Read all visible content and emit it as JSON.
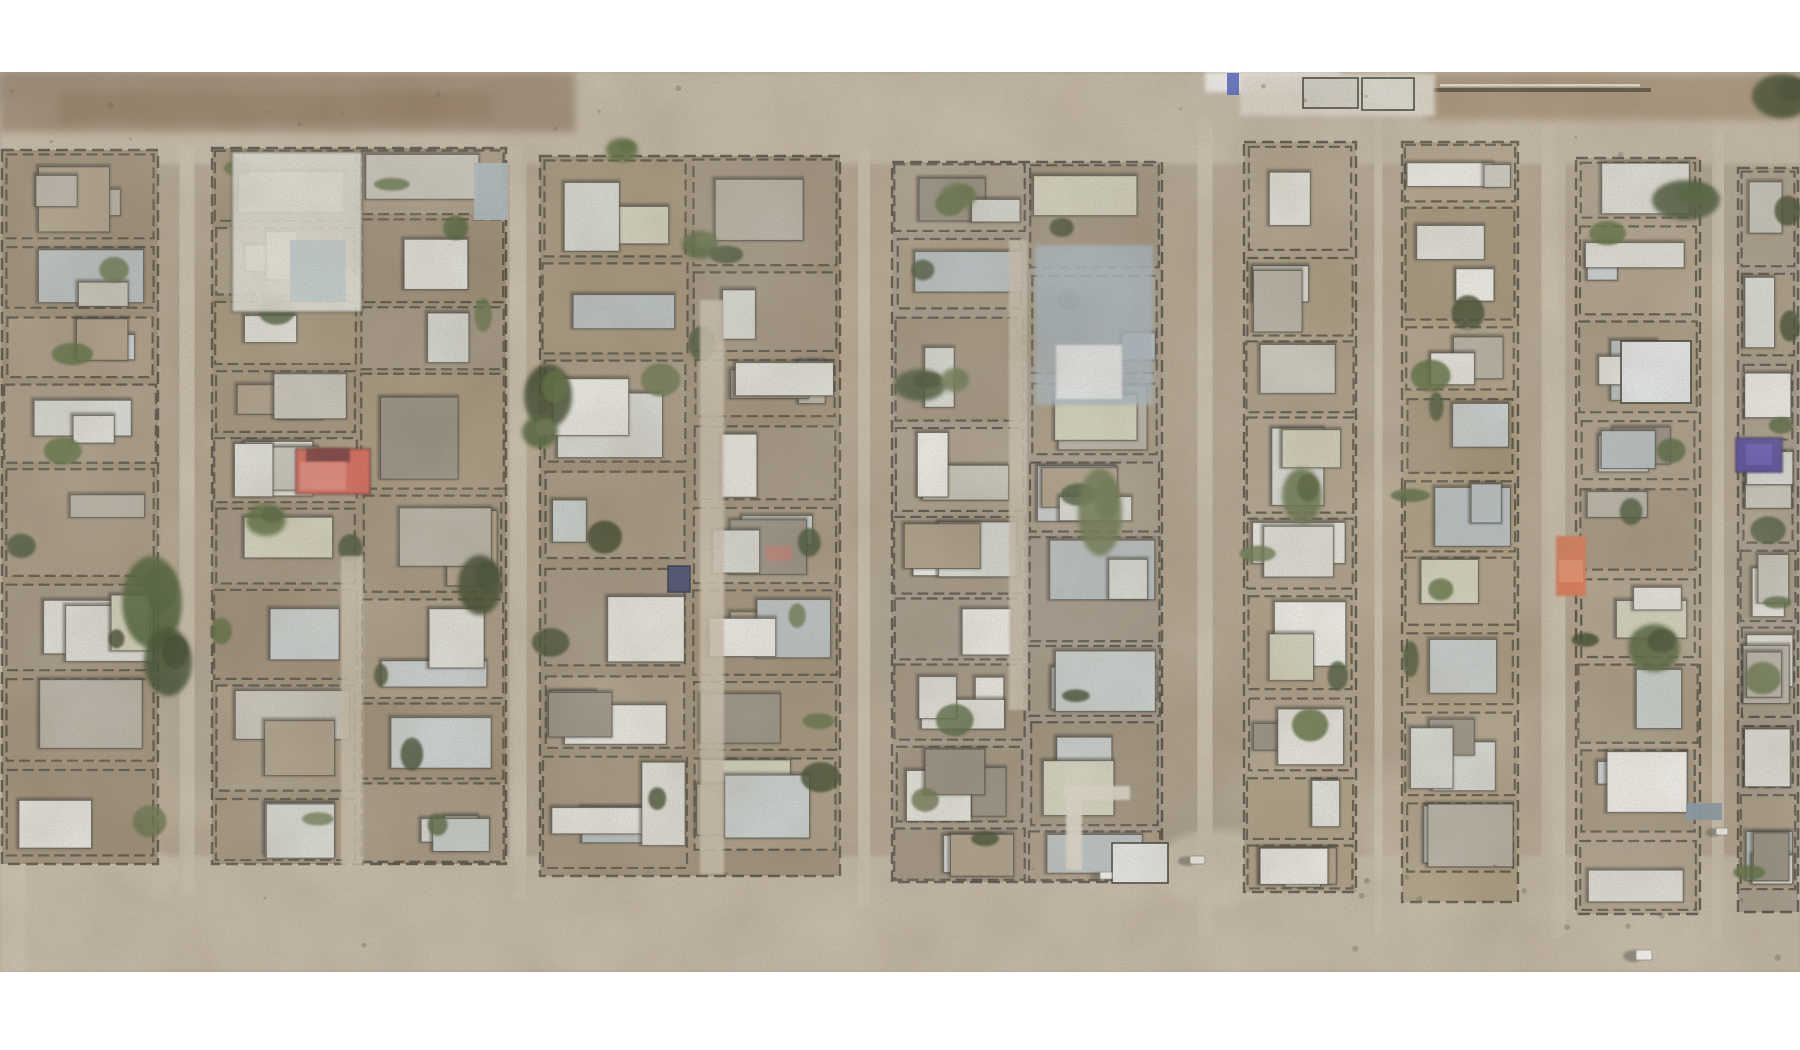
{
  "scene": {
    "canvas": {
      "width": 1800,
      "height": 1050,
      "letterbox_color": "#ffffff",
      "image_top": 72,
      "image_bottom": 972
    },
    "palette": {
      "desert_base": "#b1a28c",
      "haze": "#cfc6b6",
      "road": "#c6baa7",
      "road_light": "#cfc4b1",
      "block_ground": [
        "#a89878",
        "#9f8f76",
        "#ab9c86",
        "#95856c",
        "#b0a28c",
        "#a09484"
      ],
      "roofs": [
        "#eeefe9",
        "#e6e8e1",
        "#f5f6f2",
        "#cbcabf",
        "#b6b2a5",
        "#ccd4d6",
        "#b7c3c7",
        "#a99b84",
        "#90897b",
        "#dde1dd",
        "#d8d8c2"
      ],
      "walls": "#2c2a21",
      "roof_shadow": "#23221b",
      "trees": [
        "#2e4220",
        "#3a5226",
        "#47602c",
        "#263619",
        "#56683a"
      ],
      "mottle": [
        "#8d7d66",
        "#d3c7b2",
        "#9c9c98",
        "#b7a98f"
      ],
      "debris": "#5e5547",
      "vehicle_white": "#fbfbf9"
    },
    "regions": {
      "top_road": {
        "x": 0,
        "y": 72,
        "w": 1800,
        "h": 92
      },
      "bottom_road": {
        "x": 0,
        "y": 856,
        "w": 1800,
        "h": 116
      },
      "left_edge_strip": {
        "x": 0,
        "y": 560,
        "w": 26,
        "h": 412
      },
      "bottomleft_curve": {
        "d": "M 8 600 Q 40 790 170 888",
        "width": 46
      },
      "r4_junction_bulge": {
        "cx": 1218,
        "cy": 868,
        "rx": 64,
        "ry": 38
      }
    },
    "vertical_roads": [
      {
        "id": "r1",
        "x_top": 182,
        "x_bottom": 192,
        "w": 50,
        "y_top": 145,
        "y_bottom": 895
      },
      {
        "id": "r2",
        "x_top": 512,
        "x_bottom": 524,
        "w": 46,
        "y_top": 145,
        "y_bottom": 900
      },
      {
        "id": "r3",
        "x_top": 868,
        "x_bottom": 860,
        "w": 46,
        "y_top": 150,
        "y_bottom": 905
      },
      {
        "id": "r4",
        "x_top": 1210,
        "x_bottom": 1200,
        "w": 64,
        "y_top": 118,
        "y_bottom": 935
      },
      {
        "id": "r5",
        "x_top": 1380,
        "x_bottom": 1376,
        "w": 40,
        "y_top": 115,
        "y_bottom": 932
      },
      {
        "id": "r6",
        "x_top": 1545,
        "x_bottom": 1562,
        "w": 42,
        "y_top": 125,
        "y_bottom": 938
      },
      {
        "id": "r7",
        "x_top": 1722,
        "x_bottom": 1714,
        "w": 34,
        "y_top": 130,
        "y_bottom": 938
      }
    ],
    "blocks": [
      {
        "id": "A",
        "x0": 2,
        "x1": 158,
        "top": 150,
        "bottom": 864,
        "seed": 11
      },
      {
        "id": "B",
        "x0": 212,
        "x1": 506,
        "top": 148,
        "bottom": 864,
        "seed": 22
      },
      {
        "id": "C",
        "x0": 540,
        "x1": 840,
        "top": 156,
        "bottom": 876,
        "seed": 33
      },
      {
        "id": "D",
        "x0": 892,
        "x1": 1162,
        "top": 162,
        "bottom": 882,
        "seed": 44
      },
      {
        "id": "E",
        "x0": 1244,
        "x1": 1356,
        "top": 142,
        "bottom": 892,
        "seed": 55
      },
      {
        "id": "F",
        "x0": 1402,
        "x1": 1518,
        "top": 142,
        "bottom": 902,
        "seed": 66
      },
      {
        "id": "G",
        "x0": 1576,
        "x1": 1700,
        "top": 158,
        "bottom": 914,
        "seed": 77
      },
      {
        "id": "H",
        "x0": 1738,
        "x1": 1798,
        "top": 168,
        "bottom": 912,
        "seed": 88
      }
    ],
    "alleys": [
      {
        "x": 352,
        "y_top": 556,
        "y_bottom": 866,
        "w": 22
      },
      {
        "x": 712,
        "y_top": 300,
        "y_bottom": 874,
        "w": 24
      },
      {
        "x": 1018,
        "y_top": 240,
        "y_bottom": 710,
        "w": 18
      }
    ],
    "features": [
      {
        "name": "top-blue-gray-patch",
        "shape": "rect",
        "x": 0,
        "y": 72,
        "w": 152,
        "h": 32,
        "color": "#8b9095",
        "opacity": 0.9,
        "blur": "b4"
      },
      {
        "name": "top-brown-strip-left",
        "shape": "rect",
        "x": 0,
        "y": 72,
        "w": 575,
        "h": 60,
        "color": "#97826a",
        "opacity": 0.95,
        "blur": "b4"
      },
      {
        "name": "top-brown-strip-left-dark",
        "shape": "rect",
        "x": 60,
        "y": 92,
        "w": 430,
        "h": 30,
        "color": "#87704f",
        "opacity": 0.6,
        "blur": "b4"
      },
      {
        "name": "top-brown-strip-right",
        "shape": "rect",
        "x": 1425,
        "y": 74,
        "w": 375,
        "h": 46,
        "color": "#a28c6e",
        "opacity": 0.9,
        "blur": "b4"
      },
      {
        "name": "top-right-wall-line",
        "shape": "rect",
        "x": 1433,
        "y": 88,
        "w": 218,
        "h": 4,
        "color": "#3b3528",
        "opacity": 0.85,
        "blur": ""
      },
      {
        "name": "top-right-wall-highlight",
        "shape": "rect",
        "x": 1440,
        "y": 84,
        "w": 200,
        "h": 2.5,
        "color": "#f2f1ea",
        "opacity": 0.9,
        "blur": ""
      },
      {
        "name": "top-white-notch",
        "shape": "rect",
        "x": 1205,
        "y": 72,
        "w": 135,
        "h": 20,
        "color": "#ffffff",
        "opacity": 1,
        "blur": "b2"
      },
      {
        "name": "top-bright-ground",
        "shape": "rect",
        "x": 1240,
        "y": 74,
        "w": 195,
        "h": 42,
        "color": "#e6e1d5",
        "opacity": 0.95,
        "blur": "b2"
      },
      {
        "name": "north-row-structure-1",
        "shape": "rect",
        "x": 1303,
        "y": 78,
        "w": 55,
        "h": 30,
        "color": "#dad9d1",
        "opacity": 1,
        "blur": "",
        "stroke": "#2c2a21"
      },
      {
        "name": "north-row-structure-2",
        "shape": "rect",
        "x": 1362,
        "y": 78,
        "w": 52,
        "h": 32,
        "color": "#e2e2da",
        "opacity": 1,
        "blur": "",
        "stroke": "#2c2a21"
      },
      {
        "name": "top-blue-mark",
        "shape": "rect",
        "x": 1227,
        "y": 73,
        "w": 12,
        "h": 22,
        "color": "#3f57c8",
        "opacity": 0.95,
        "blur": ""
      },
      {
        "name": "big-white-compound-blockB",
        "shape": "rect",
        "x": 232,
        "y": 152,
        "w": 130,
        "h": 160,
        "color": "#e9e9df",
        "opacity": 0.9,
        "blur": "b1",
        "stroke": "#2c2a21"
      },
      {
        "name": "blockB-bluish-roof",
        "shape": "rect",
        "x": 290,
        "y": 240,
        "w": 56,
        "h": 62,
        "color": "#c3d2d6",
        "opacity": 0.95,
        "blur": ""
      },
      {
        "name": "blockB-east-bluegray-roof",
        "shape": "rect",
        "x": 474,
        "y": 163,
        "w": 34,
        "h": 57,
        "color": "#a9bcc4",
        "opacity": 0.95,
        "blur": ""
      },
      {
        "name": "red-building-base",
        "shape": "rect",
        "x": 296,
        "y": 449,
        "w": 74,
        "h": 45,
        "color": "#d85a4c",
        "opacity": 1,
        "blur": "b1",
        "stroke": "#5a2420"
      },
      {
        "name": "red-building-maroon-patch",
        "shape": "rect",
        "x": 306,
        "y": 448,
        "w": 44,
        "h": 14,
        "color": "#63262b",
        "opacity": 0.9,
        "blur": "b1"
      },
      {
        "name": "red-building-bright-patch",
        "shape": "rect",
        "x": 300,
        "y": 462,
        "w": 46,
        "h": 28,
        "color": "#e98074",
        "opacity": 0.9,
        "blur": "b1"
      },
      {
        "name": "small-red-roof",
        "shape": "rect",
        "x": 766,
        "y": 546,
        "w": 26,
        "h": 15,
        "color": "#c4766c",
        "opacity": 0.85,
        "blur": "b1"
      },
      {
        "name": "navy-structure",
        "shape": "rect",
        "x": 668,
        "y": 566,
        "w": 22,
        "h": 26,
        "color": "#2d3764",
        "opacity": 1,
        "blur": "",
        "stroke": "#1c2138"
      },
      {
        "name": "bluish-compound",
        "shape": "rect",
        "x": 1035,
        "y": 245,
        "w": 118,
        "h": 160,
        "color": "#a5b8c5",
        "opacity": 0.85,
        "blur": "b2"
      },
      {
        "name": "bluish-compound-core",
        "shape": "rect",
        "x": 1056,
        "y": 345,
        "w": 66,
        "h": 54,
        "color": "#eff5f8",
        "opacity": 0.95,
        "blur": "b1"
      },
      {
        "name": "white-path-vertical",
        "shape": "rect",
        "x": 1066,
        "y": 790,
        "w": 16,
        "h": 80,
        "color": "#e3ddd0",
        "opacity": 0.95,
        "blur": "b1"
      },
      {
        "name": "white-path-horizontal",
        "shape": "rect",
        "x": 1064,
        "y": 786,
        "w": 66,
        "h": 14,
        "color": "#e3ddd0",
        "opacity": 0.95,
        "blur": "b1"
      },
      {
        "name": "bright-white-building-bottom",
        "shape": "rect",
        "x": 1112,
        "y": 843,
        "w": 56,
        "h": 40,
        "color": "#eef1f1",
        "opacity": 1,
        "blur": "",
        "stroke": "#2a2920"
      },
      {
        "name": "indigo-structure",
        "shape": "rect",
        "x": 1736,
        "y": 438,
        "w": 46,
        "h": 34,
        "color": "#473a9c",
        "opacity": 1,
        "blur": "b1",
        "stroke": "#2a2158"
      },
      {
        "name": "indigo-structure-center",
        "shape": "rect",
        "x": 1746,
        "y": 444,
        "w": 26,
        "h": 21,
        "color": "#5b4db8",
        "opacity": 0.95,
        "blur": ""
      },
      {
        "name": "orange-building",
        "shape": "rect",
        "x": 1556,
        "y": 536,
        "w": 30,
        "h": 60,
        "color": "#df704c",
        "opacity": 1,
        "blur": "b1"
      },
      {
        "name": "orange-building-bright",
        "shape": "rect",
        "x": 1559,
        "y": 560,
        "w": 24,
        "h": 22,
        "color": "#ec8a62",
        "opacity": 0.9,
        "blur": ""
      },
      {
        "name": "bright-white-building-right",
        "shape": "rect",
        "x": 1621,
        "y": 341,
        "w": 70,
        "h": 62,
        "color": "#ecf3f6",
        "opacity": 1,
        "blur": "",
        "stroke": "#23221c"
      },
      {
        "name": "teal-roof",
        "shape": "rect",
        "x": 1686,
        "y": 803,
        "w": 36,
        "h": 17,
        "color": "#7e95a4",
        "opacity": 0.95,
        "blur": ""
      }
    ],
    "trees": [
      {
        "x": 152,
        "y": 602,
        "rx": 30,
        "ry": 46
      },
      {
        "x": 168,
        "y": 662,
        "rx": 24,
        "ry": 34
      },
      {
        "x": 548,
        "y": 396,
        "rx": 24,
        "ry": 32
      },
      {
        "x": 540,
        "y": 432,
        "rx": 18,
        "ry": 16
      },
      {
        "x": 1100,
        "y": 512,
        "rx": 22,
        "ry": 44
      },
      {
        "x": 1686,
        "y": 200,
        "rx": 34,
        "ry": 20
      },
      {
        "x": 1654,
        "y": 648,
        "rx": 26,
        "ry": 24
      },
      {
        "x": 1302,
        "y": 496,
        "rx": 20,
        "ry": 28
      },
      {
        "x": 266,
        "y": 520,
        "rx": 20,
        "ry": 16
      },
      {
        "x": 958,
        "y": 196,
        "rx": 18,
        "ry": 13
      },
      {
        "x": 920,
        "y": 385,
        "rx": 26,
        "ry": 16
      },
      {
        "x": 955,
        "y": 380,
        "rx": 14,
        "ry": 12
      },
      {
        "x": 1782,
        "y": 96,
        "rx": 30,
        "ry": 22
      },
      {
        "x": 480,
        "y": 585,
        "rx": 22,
        "ry": 30
      },
      {
        "x": 622,
        "y": 150,
        "rx": 16,
        "ry": 12
      },
      {
        "x": 700,
        "y": 245,
        "rx": 18,
        "ry": 14
      }
    ],
    "vehicles": [
      {
        "name": "white-car-road4",
        "x": 1190,
        "y": 856,
        "w": 15,
        "h": 8
      },
      {
        "name": "white-car-blockH",
        "x": 1716,
        "y": 828,
        "w": 12,
        "h": 7
      },
      {
        "name": "white-car-bottom-road",
        "x": 1636,
        "y": 950,
        "w": 16,
        "h": 10
      },
      {
        "name": "white-car-bottom-road-2",
        "x": 1100,
        "y": 872,
        "w": 12,
        "h": 7
      }
    ],
    "generation": {
      "mottle_count": 48,
      "mottle_seed": 7,
      "debris_count": 36,
      "debris_seed": 13
    }
  }
}
